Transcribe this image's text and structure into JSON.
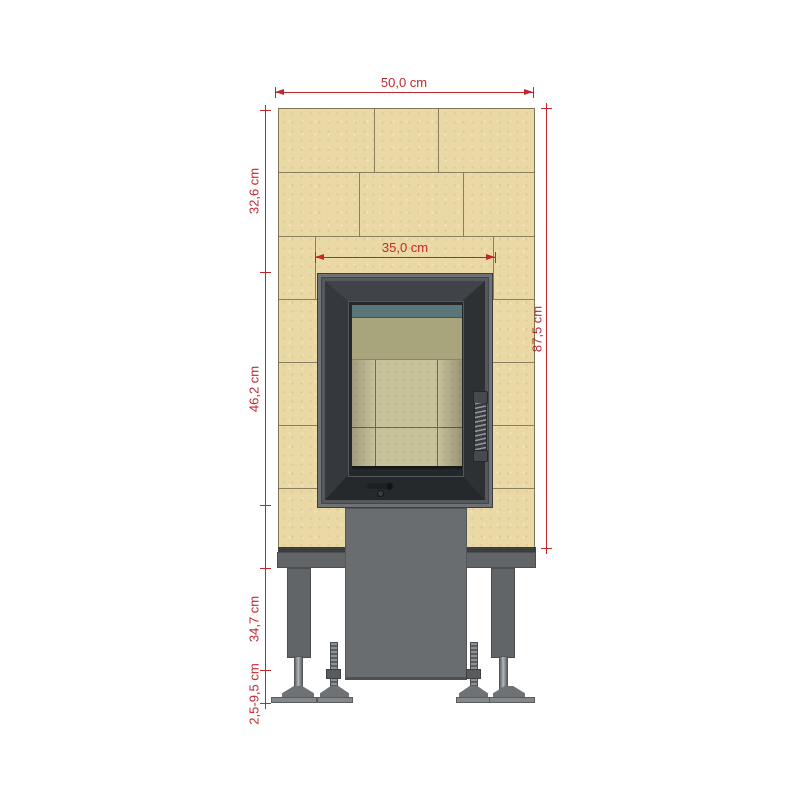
{
  "diagram": {
    "type": "technical-drawing",
    "subject": "fireplace-insert-front-elevation-with-tile-cladding",
    "units": "cm",
    "dims": {
      "width_total": "50,0 cm",
      "width_insert": "35,0 cm",
      "height_upper": "32,6 cm",
      "height_insert": "46,2 cm",
      "height_total": "87,5 cm",
      "height_base": "34,7 cm",
      "height_feet_range": "2,5-9,5 cm"
    },
    "colors": {
      "dimension_red": "#c1272d",
      "tile_tan": "#ead9a5",
      "frame_dark_gray": "#303337",
      "steel_gray": "#65686b",
      "firebrick": "#c8c29b",
      "baffle_olive": "#a8a47b",
      "baffle_teal": "#5b7678",
      "background": "#ffffff"
    }
  }
}
